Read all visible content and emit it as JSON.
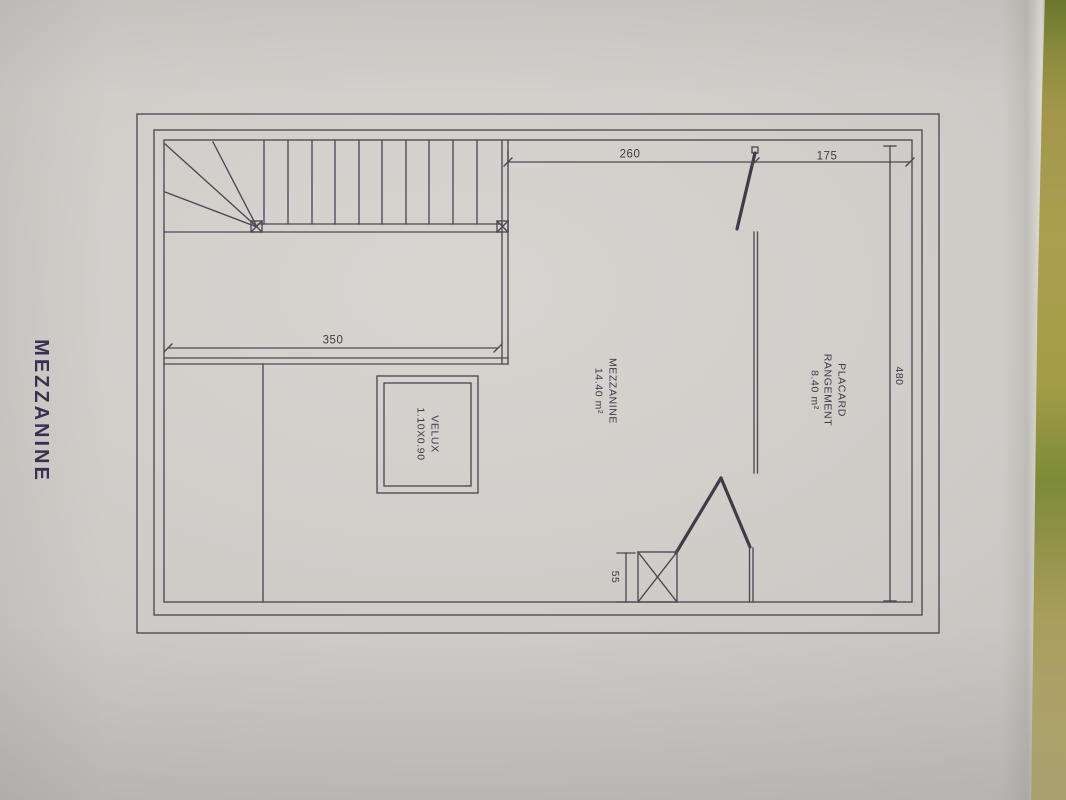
{
  "title": "MEZZANINE",
  "plan": {
    "rooms": {
      "mezzanine": {
        "name": "MEZZANINE",
        "area": "14.40 m²"
      },
      "placard": {
        "line1": "PLACARD",
        "line2": "RANGEMENT",
        "area": "8.40 m²"
      }
    },
    "window": {
      "name": "VELUX",
      "size": "1.10X0.90"
    },
    "dims": {
      "top_left": "260",
      "top_right": "175",
      "stairwell": "350",
      "depth": "480",
      "duct": "55"
    }
  },
  "colors": {
    "paper": "#cfccc8",
    "ink": "#4c4854",
    "label_text": "#3d3947",
    "title_text": "#363152",
    "table_olive": "#ab9f50",
    "table_green": "#6e7b2d"
  }
}
